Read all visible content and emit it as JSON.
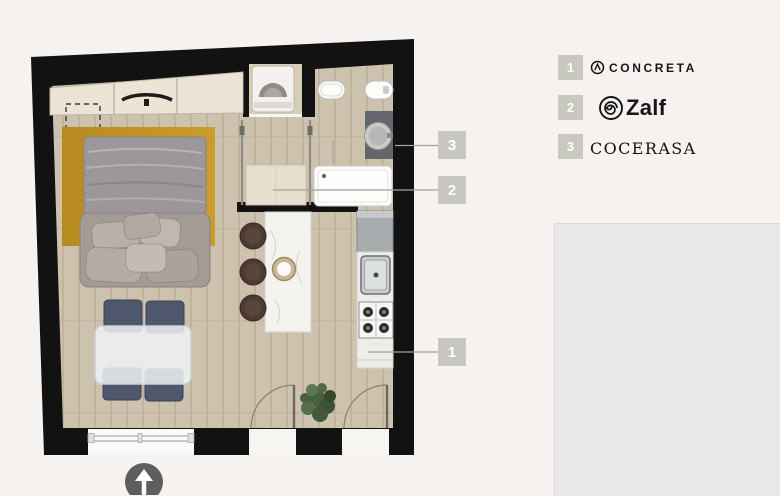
{
  "plan": {
    "callouts": [
      {
        "number": "1",
        "points_to": "kitchen-counter"
      },
      {
        "number": "2",
        "points_to": "closet-cabin"
      },
      {
        "number": "3",
        "points_to": "bathroom-vanity"
      }
    ],
    "compass": "north-arrow"
  },
  "legend": {
    "items": [
      {
        "number": "1",
        "brand": "CONCRETA",
        "icon": "circle-lambda-icon"
      },
      {
        "number": "2",
        "brand": "Zalf",
        "icon": "spiral-icon"
      },
      {
        "number": "3",
        "brand": "COCERASA",
        "icon": "serif-logotype"
      }
    ]
  },
  "colors": {
    "background": "#f5f2ef",
    "wall": "#121212",
    "floor": "#cdc2ad",
    "rug": "#bd9125",
    "callout_box": "#c8c7bf",
    "legend_box": "#c9c8bf",
    "card": "#e9e9eb",
    "north_circle": "#5e5e5e"
  }
}
